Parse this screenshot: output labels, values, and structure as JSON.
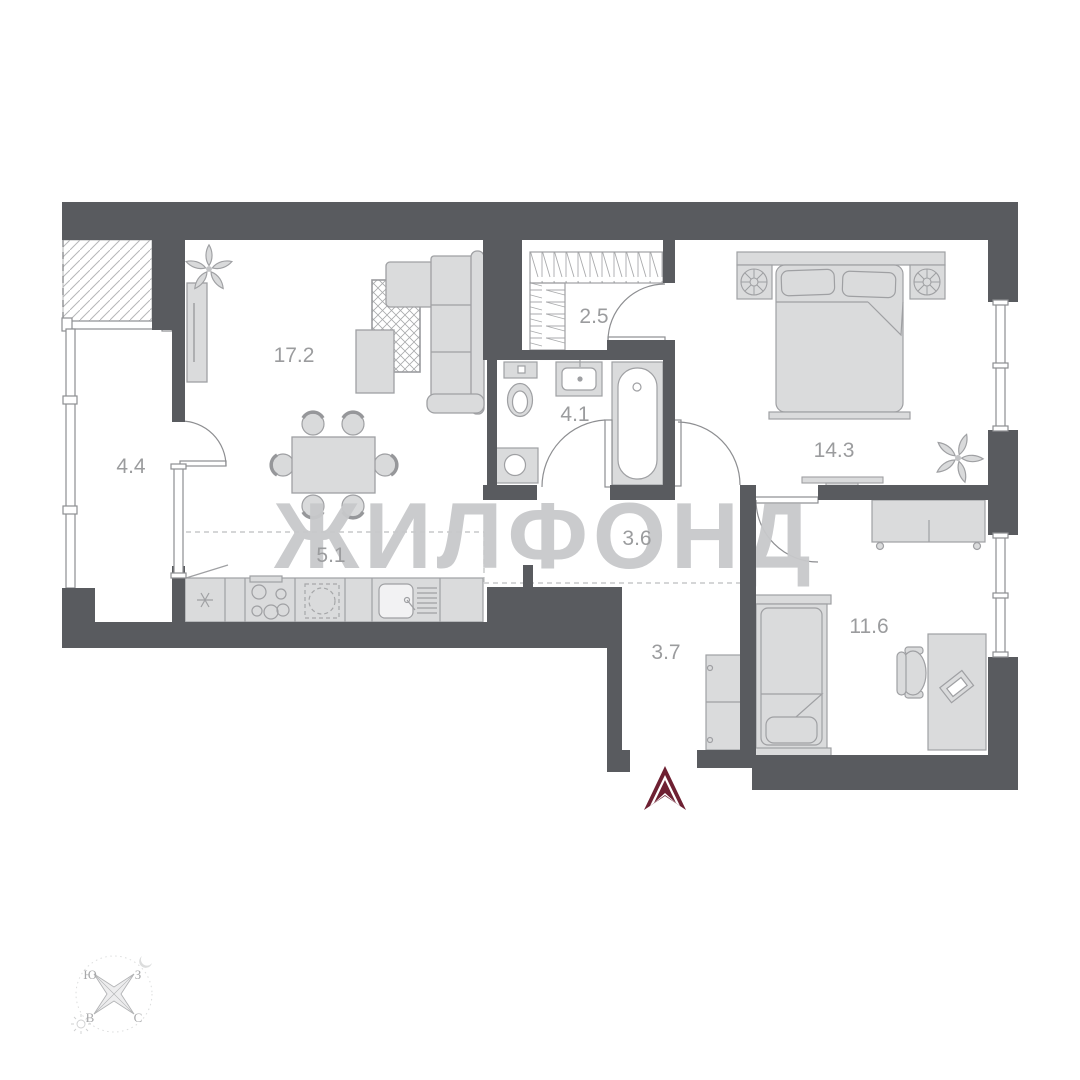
{
  "watermark": "ЖИЛФОНД",
  "rooms": {
    "living": {
      "name": "living-room",
      "label": "17.2"
    },
    "balcony": {
      "name": "balcony",
      "label": "4.4"
    },
    "wardrobe": {
      "name": "wardrobe-room",
      "label": "2.5"
    },
    "bathroom": {
      "name": "bathroom",
      "label": "4.1"
    },
    "bedroom": {
      "name": "bedroom",
      "label": "14.3"
    },
    "kitchen": {
      "name": "kitchen-zone",
      "label": "5.1"
    },
    "hall": {
      "name": "hall",
      "label": "3.6"
    },
    "corridor": {
      "name": "entry-corridor",
      "label": "3.7"
    },
    "child": {
      "name": "second-room",
      "label": "11.6"
    }
  },
  "compass": {
    "south": "Ю",
    "west": "З",
    "east": "В",
    "north": "С"
  },
  "colors": {
    "wall": "#595b5f",
    "furniture_fill": "#dadbdc",
    "furniture_stroke": "#9fa0a3",
    "room_label": "#9b9c9e",
    "watermark": "#c8c9cb",
    "entrance_arrow": "#6e2032"
  }
}
